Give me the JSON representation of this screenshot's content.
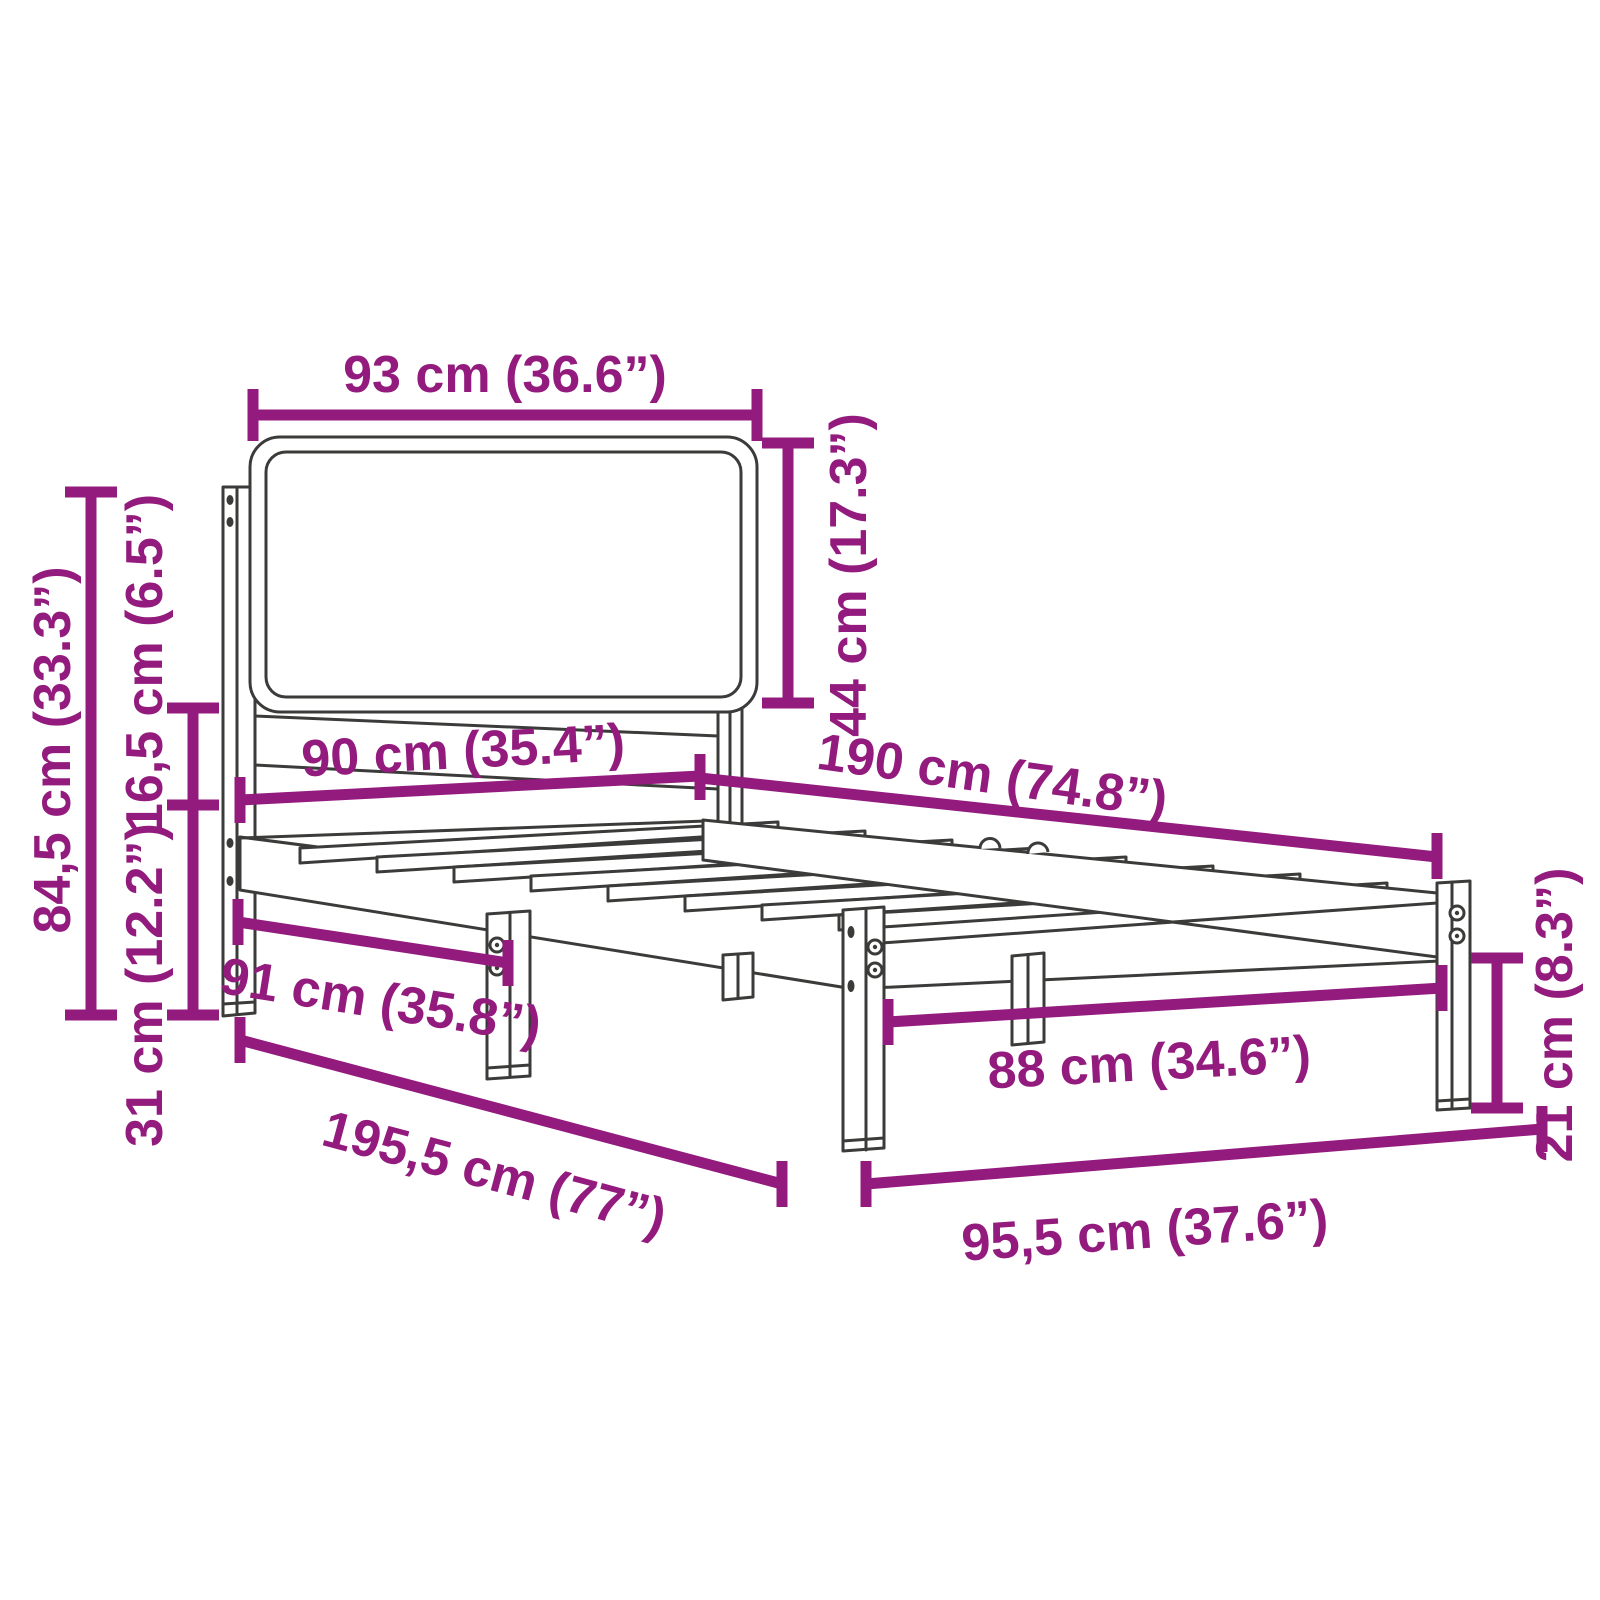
{
  "diagram": {
    "title": "Bed frame dimension diagram",
    "product": "Bed frame with upholstered headboard",
    "background_color": "#ffffff",
    "accent_color": "#931B7E",
    "line_color": "#3B3B3A",
    "units": [
      "cm",
      "inches"
    ],
    "labels": {
      "headboard_width": "93 cm (36.6”)",
      "headboard_panel_height": "44 cm (17.3”)",
      "total_height": "84,5 cm (33.3”)",
      "panel_gap_height": "16,5 cm (6.5”)",
      "frame_height": "31 cm (12.2”)",
      "mattress_width": "90 cm (35.4”)",
      "mattress_length": "190 cm (74.8”)",
      "headboard_side_span": "91 cm (35.8”)",
      "total_length": "195,5 cm (77”)",
      "total_width": "95,5 cm (37.6”)",
      "leg_clearance_width": "88 cm (34.6”)",
      "leg_height": "21 cm (8.3”)"
    }
  }
}
